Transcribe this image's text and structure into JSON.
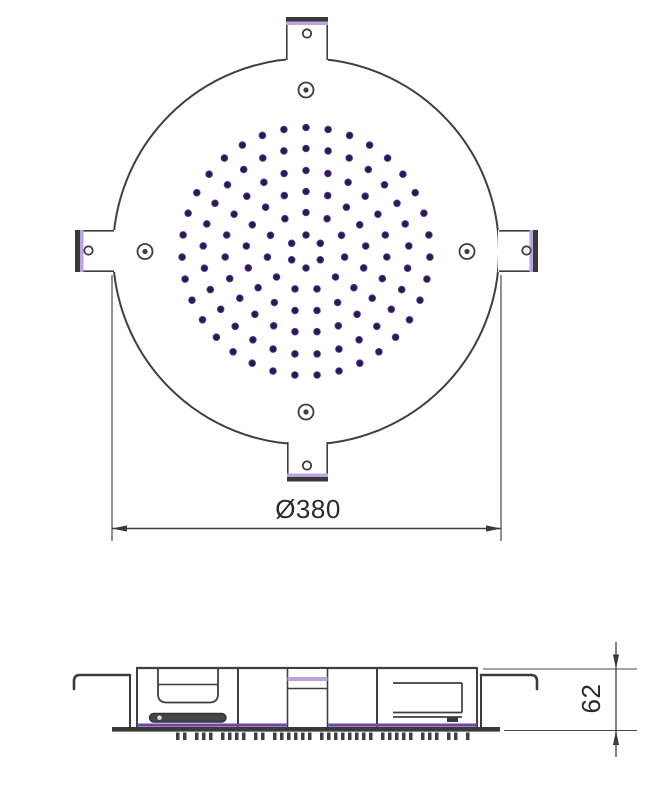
{
  "drawing": {
    "kind": "technical-drawing",
    "subject": "round-ceiling-shower-head"
  },
  "colors": {
    "background": "#ffffff",
    "line": "#3f3f3f",
    "thick_bar": "#383838",
    "accent_light_purple": "#bea4de",
    "accent_purple": "#6f46a8",
    "nozzle_dot": "#281a52",
    "text": "#2b2b2b"
  },
  "top_view": {
    "diameter_dimension": {
      "label": "Ø380",
      "value": 380,
      "unit": "mm"
    },
    "nozzle_pattern": {
      "center_x": 306,
      "center_y": 251.5,
      "dot_radius": 3.4,
      "rings": [
        {
          "r": 16.5,
          "count": 6
        },
        {
          "r": 39,
          "count": 11
        },
        {
          "r": 60,
          "count": 17
        },
        {
          "r": 81,
          "count": 23
        },
        {
          "r": 103,
          "count": 29
        },
        {
          "r": 124,
          "count": 35
        }
      ]
    }
  },
  "side_view": {
    "height_dimension": {
      "label": "62",
      "value": 62,
      "unit": "mm"
    },
    "teeth": {
      "start_x": 176,
      "y": 732.5,
      "height": 7.5,
      "tooth_width": 3.5,
      "tooth_gap": 3.5,
      "group_gap": 5,
      "groups": [
        2,
        3,
        4,
        2,
        6,
        8,
        5,
        3,
        2,
        1
      ]
    }
  }
}
